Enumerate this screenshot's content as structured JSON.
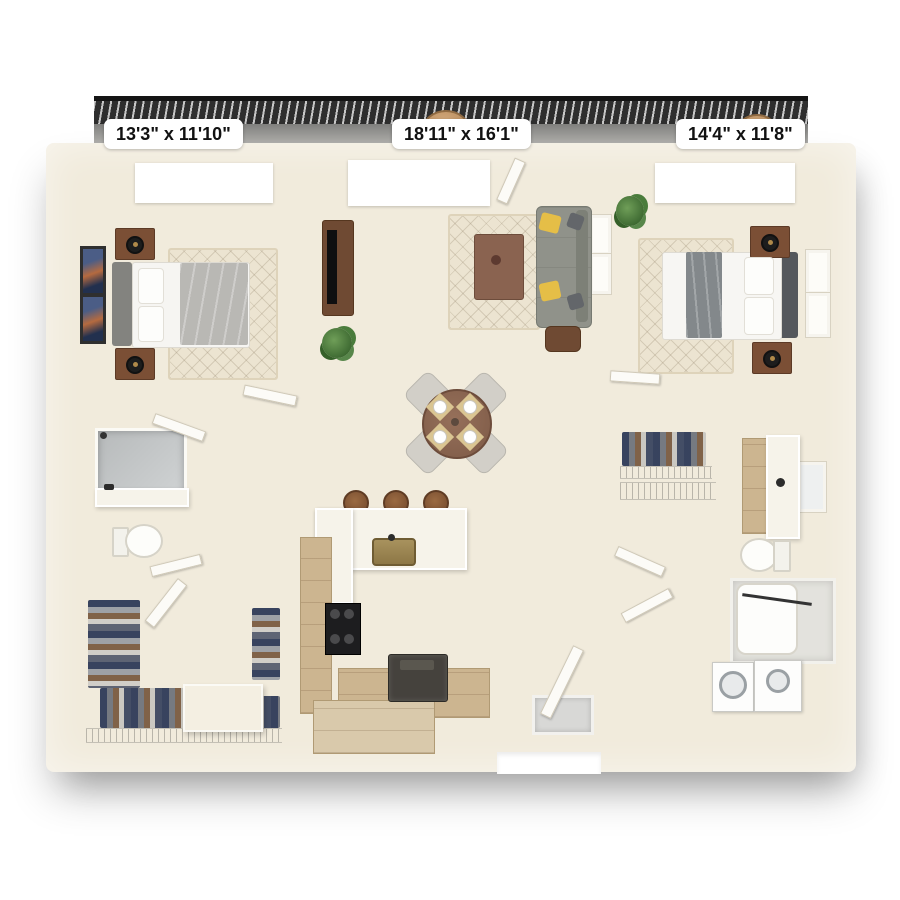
{
  "floorplan": {
    "type": "apartment-floor-plan-3d-top-view",
    "rooms": [
      {
        "name": "bedroom-1",
        "dimensions": "13'3\" x 11'10\""
      },
      {
        "name": "living-dining",
        "dimensions": "18'11\" x 16'1\""
      },
      {
        "name": "bedroom-2",
        "dimensions": "14'4\" x 11'8\""
      }
    ],
    "features": [
      "balcony",
      "bedroom-1",
      "living-room",
      "dining-area",
      "kitchen",
      "bedroom-2",
      "bathroom-1",
      "walk-in-closet-1",
      "bathroom-2",
      "walk-in-closet-2",
      "washer-dryer",
      "entry-door"
    ],
    "colors": {
      "wall": "#f1ebdc",
      "wood_floor": "#b29779",
      "railing": "#2e2e2e",
      "label_bg": "#ffffff",
      "label_text": "#111111",
      "sofa": "#90928a",
      "accent_pillow": "#e5be47",
      "bed_gray": "#86867f",
      "nightstand_wood": "#7b4f35",
      "tile_gray": "#b7babb"
    }
  }
}
